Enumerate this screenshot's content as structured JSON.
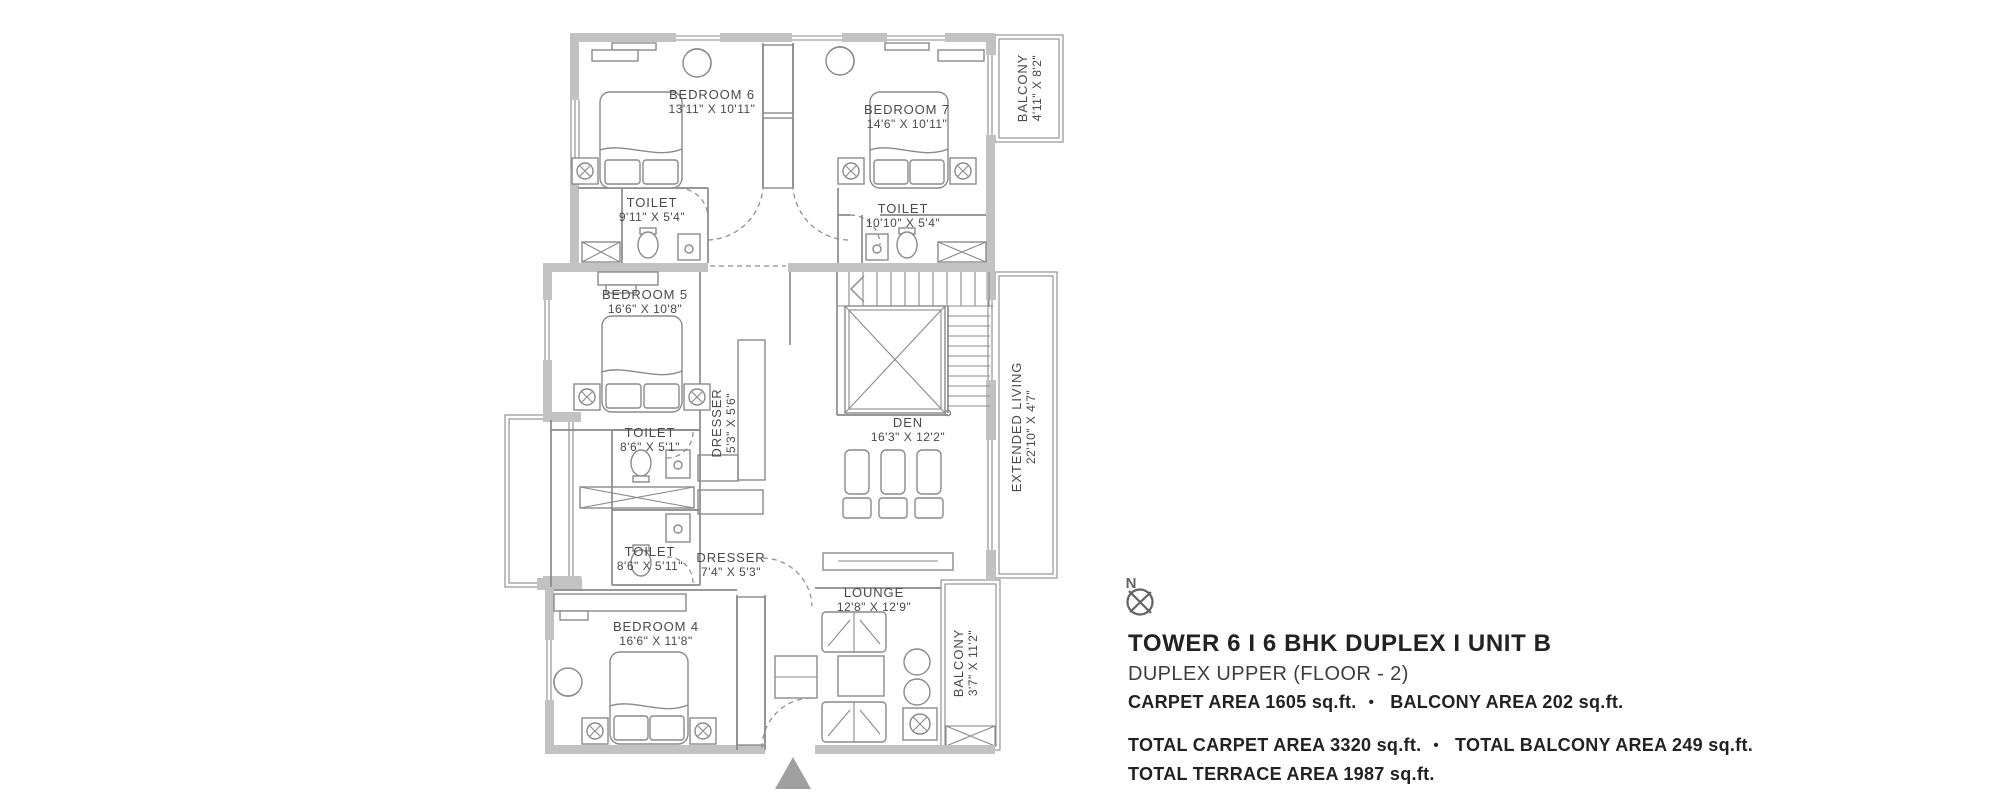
{
  "colors": {
    "wall": "#c2c2c2",
    "line": "#8a8a8a",
    "text": "#4a4a4a",
    "title": "#222222",
    "arrow": "#a0a0a0",
    "compass": "#636363"
  },
  "plan": {
    "rooms": [
      {
        "id": "bedroom6",
        "name": "BEDROOM 6",
        "dims": "13'11\" X 10'11\""
      },
      {
        "id": "bedroom7",
        "name": "BEDROOM 7",
        "dims": "14'6\" X 10'11\""
      },
      {
        "id": "balcony-top",
        "name": "BALCONY",
        "dims": "4'11\" X 8'2\""
      },
      {
        "id": "toilet-bed6",
        "name": "TOILET",
        "dims": "9'11\" X 5'4\""
      },
      {
        "id": "toilet-bed7",
        "name": "TOILET",
        "dims": "10'10\" X 5'4\""
      },
      {
        "id": "bedroom5",
        "name": "BEDROOM 5",
        "dims": "16'6\" X 10'8\""
      },
      {
        "id": "dresser-bed5",
        "name": "DRESSER",
        "dims": "5'3\" X 5'6\""
      },
      {
        "id": "toilet-bed5",
        "name": "TOILET",
        "dims": "8'6\" X 5'1\""
      },
      {
        "id": "toilet-bed4",
        "name": "TOILET",
        "dims": "8'6\" X 5'11\""
      },
      {
        "id": "dresser-bed4",
        "name": "DRESSER",
        "dims": "7'4\" X 5'3\""
      },
      {
        "id": "den",
        "name": "DEN",
        "dims": "16'3\" X 12'2\""
      },
      {
        "id": "extended-living",
        "name": "EXTENDED LIVING",
        "dims": "22'10\" X 4'7\""
      },
      {
        "id": "bedroom4",
        "name": "BEDROOM 4",
        "dims": "16'6\" X 11'8\""
      },
      {
        "id": "lounge",
        "name": "LOUNGE",
        "dims": "12'8\" X 12'9\""
      },
      {
        "id": "balcony-bottom",
        "name": "BALCONY",
        "dims": "3'7\" X 11'2\""
      }
    ],
    "compass_label": "N"
  },
  "info": {
    "title": "TOWER 6  I  6 BHK DUPLEX  I  UNIT B",
    "subtitle": "DUPLEX UPPER (FLOOR - 2)",
    "bullet": "•",
    "carpet_area": "CARPET AREA 1605 sq.ft.",
    "balcony_area": "BALCONY AREA 202 sq.ft.",
    "total_carpet_area": "TOTAL CARPET AREA 3320 sq.ft.",
    "total_balcony_area": "TOTAL BALCONY AREA 249 sq.ft.",
    "total_terrace_area": "TOTAL TERRACE AREA 1987 sq.ft."
  }
}
